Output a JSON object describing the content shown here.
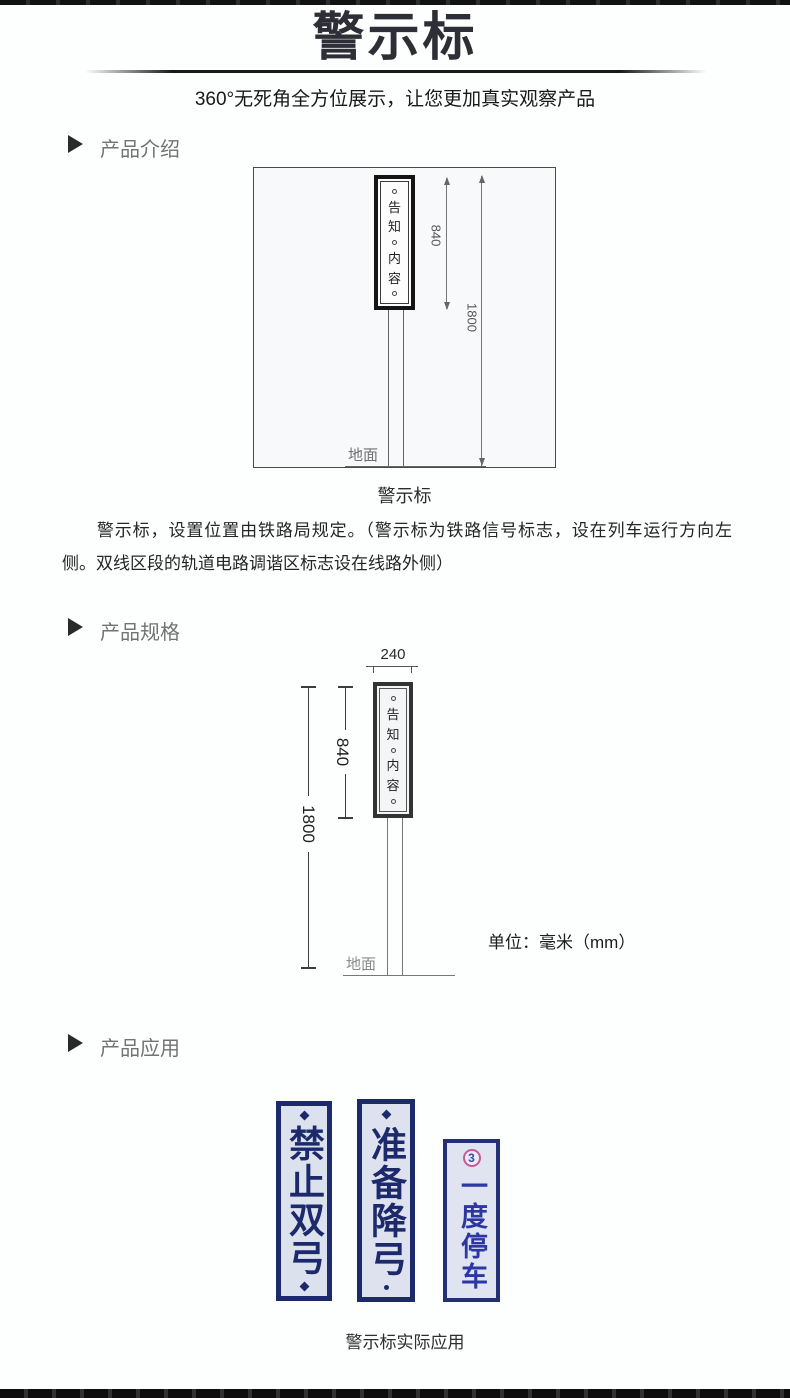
{
  "page": {
    "title": "警示标",
    "subtitle": "360°无死角全方位展示，让您更加真实观察产品"
  },
  "sections": {
    "intro_label": "产品介绍",
    "spec_label": "产品规格",
    "app_label": "产品应用"
  },
  "plate": {
    "chars": [
      "告",
      "知",
      "内",
      "容"
    ]
  },
  "diagram_intro": {
    "dim_sign_height": "840",
    "dim_total_height": "1800",
    "ground_label": "地面",
    "caption": "警示标"
  },
  "intro_text": "警示标，设置位置由铁路局规定。（警示标为铁路信号标志，设在列车运行方向左侧。双线区段的轨道电路调谐区标志设在线路外侧）",
  "diagram_spec": {
    "dim_width": "240",
    "dim_sign_height": "840",
    "dim_total_height": "1800",
    "ground_label": "地面",
    "units_label": "单位：毫米（mm）"
  },
  "application": {
    "signs": [
      {
        "text": "禁止双弓"
      },
      {
        "text": "准备降弓"
      },
      {
        "text": "一度停车",
        "badge": "3"
      }
    ],
    "caption": "警示标实际应用"
  },
  "colors": {
    "bar_dark": "#121212",
    "title_text": "#2e2e37",
    "section_label": "#737373",
    "sign_navy": "#1c296b",
    "sign_bg": "#dce1ee",
    "badge_pink": "#c45a96"
  }
}
